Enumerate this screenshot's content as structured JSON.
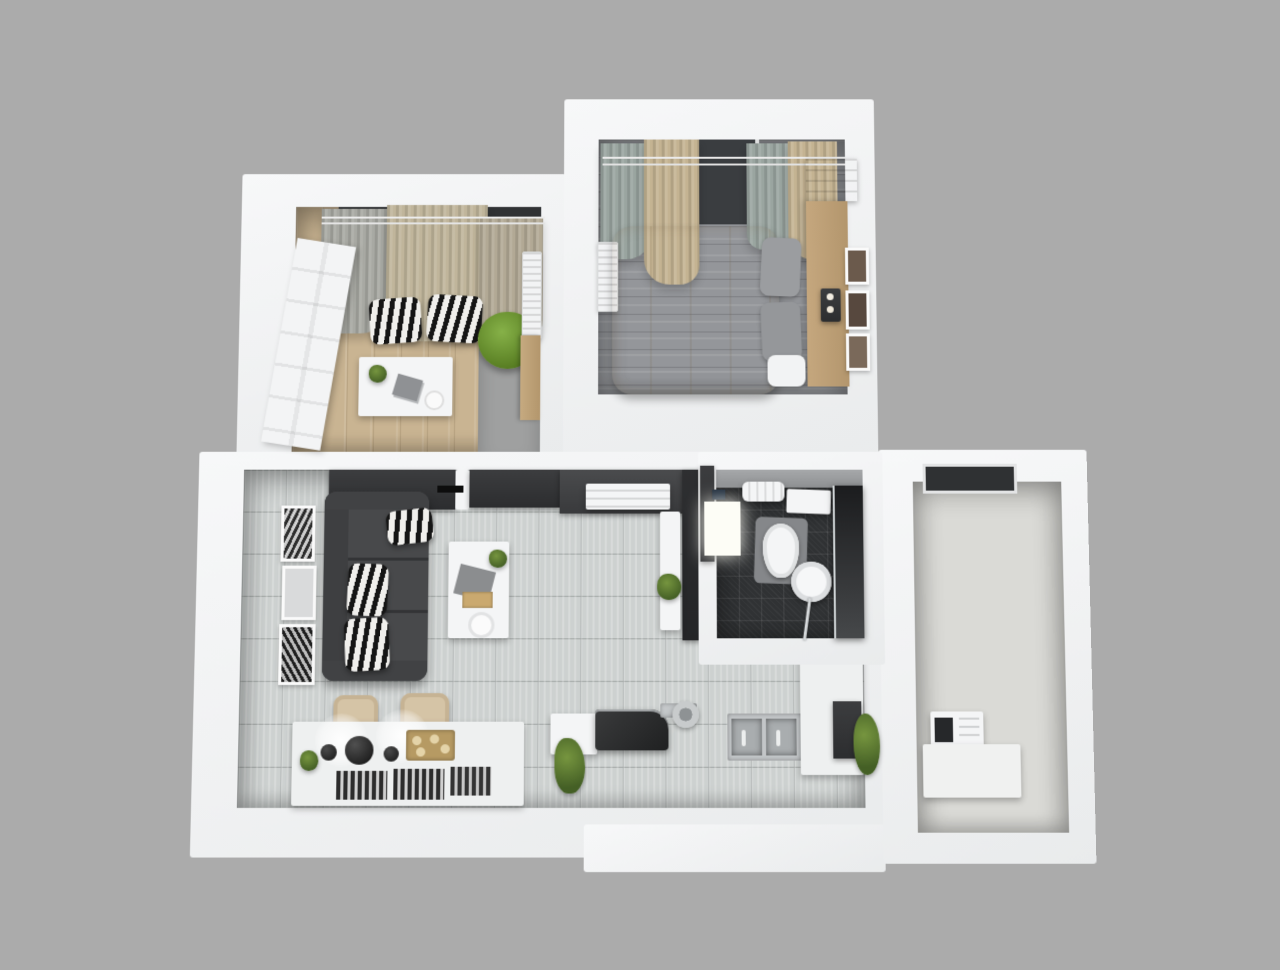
{
  "scene": {
    "type": "3d-apartment-floor-plan-render",
    "view": "top-down dollhouse view, roof removed",
    "background_color": "#ababab",
    "wall_color": "#f1f2f3",
    "rooms_count": 5
  },
  "palette": {
    "wood_floor": "#c9b492",
    "gray_plank_floor": "#94969a",
    "tile_floor": "#cdd1d0",
    "bathroom_floor": "#303234",
    "balcony_floor": "#dadad6",
    "sofa": "#48494b",
    "bed_duvet": "#d7cab0",
    "accent_chair_green": "#76a23a",
    "zebra_pattern": "#151515 / #f0efec",
    "chair_beige": "#d5c4a6",
    "cooktop_dark": "#2a2b2c",
    "steel": "#b9bcbe"
  },
  "rooms": {
    "study": {
      "name": "Study room (top-left)",
      "floor": "light wood + gray concrete strip",
      "furniture": [
        "white paneled door",
        "window with curtains",
        "curtain rod",
        "zebra floor cushion x2",
        "green accent chair",
        "white desk with plant, papers and plate",
        "wall radiator",
        "wood wardrobe"
      ]
    },
    "bedroom": {
      "name": "Bedroom (top-right)",
      "floor": "gray wood planks",
      "furniture": [
        "double bed with beige duvet",
        "two gray pillows",
        "wood headboard",
        "nightstand with candles",
        "three picture frames",
        "curtains with rod",
        "window",
        "wall radiator",
        "wood shelf steps"
      ]
    },
    "living_kitchen": {
      "name": "Living room / kitchen / dining (bottom)",
      "floor": "light gray tiles",
      "furniture": [
        "dark gray sofa with three zebra pillows",
        "white coffee table with plant, cloth, tray and plate",
        "dark media wall with TV",
        "air-conditioner unit",
        "three picture frames",
        "white console with plant",
        "dining table with bowls, gold tray, placemats and plant",
        "two beige chairs",
        "pendant light glow x2",
        "kitchen bench",
        "dark cooktop with hood",
        "round steel pan",
        "double stainless sink",
        "kitchen counter L",
        "dark oven",
        "plants"
      ]
    },
    "bathroom": {
      "name": "Bathroom (middle-right)",
      "floor": "dark charcoal tiles",
      "furniture": [
        "dark door panel",
        "glowing vanity cabinet",
        "towel radiator",
        "towel shelf",
        "toilet on gray mat",
        "round washbasin with chrome faucet",
        "dark shower glass panel"
      ]
    },
    "balcony": {
      "name": "Balcony / utility room (right)",
      "floor": "light gray",
      "furniture": [
        "window",
        "washing machine",
        "white counter"
      ]
    }
  }
}
